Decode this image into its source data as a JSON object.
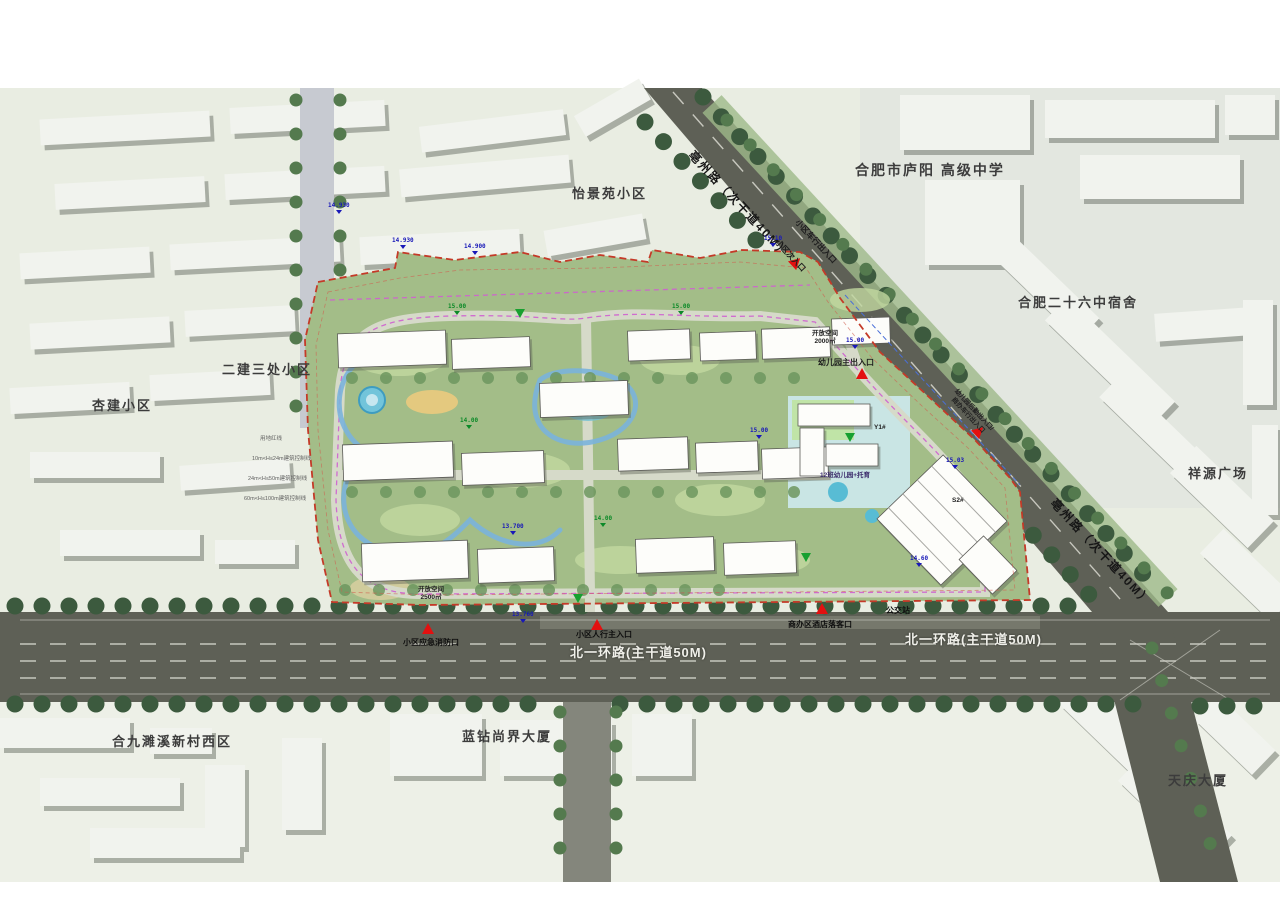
{
  "plan": {
    "roads": {
      "bozhou_label": "亳州路（次干道40M）",
      "beiyihuan_label": "北一环路(主干道50M)"
    },
    "context": {
      "school": "合肥市庐阳 高级中学",
      "yijingyuan": "怡景苑小区",
      "no26_dorm": "合肥二十六中宿舍",
      "xiangyuan": "祥源广场",
      "erjian": "二建三处小区",
      "xingjian": "杏建小区",
      "hejiu": "合九濉溪新村西区",
      "lanzuan": "蓝钻尚界大厦",
      "tianqing": "天庆大厦"
    },
    "entrances": {
      "vehicle_exit": "小区车行出入口",
      "secondary": "小区次入口",
      "kindergarten_main": "幼儿园主出入口",
      "kindergarten_service_line1": "幼儿园后勤出入口/",
      "kindergarten_service_line2": "商办车行出入口",
      "pedestrian_main": "小区人行主入口",
      "emergency_fire": "小区应急消防口",
      "hotel_dropoff": "商办区酒店落客口",
      "bus_stop": "公交站"
    },
    "open_spaces": {
      "os2500_line1": "开放空间",
      "os2500_line2": "2500㎡",
      "os2000_line1": "开放空间",
      "os2000_line2": "2000㎡"
    },
    "site": {
      "building_y1": "Y1#",
      "building_s2": "S2#",
      "kindergarten": "12班幼儿园+托育"
    },
    "elevations": [
      "14.930",
      "14.930",
      "14.900",
      "15.10",
      "15.00",
      "15.00",
      "15.00",
      "14.00",
      "15.00",
      "14.00",
      "13.700",
      "13.760",
      "15.03",
      "14.60"
    ],
    "setback_lines": [
      "用地红线",
      "10m<H≤24m建筑控制线",
      "24m<H≤50m建筑控制线",
      "60m<H≤100m建筑控制线"
    ],
    "colors": {
      "road": "#5e6056",
      "tree": "#3c5a3e",
      "site_green": "#a3bd88",
      "boundary_red": "#c43a28",
      "water": "#7ab2dc",
      "marker_red": "#e31010",
      "elevation_blue": "#1818b8"
    }
  }
}
